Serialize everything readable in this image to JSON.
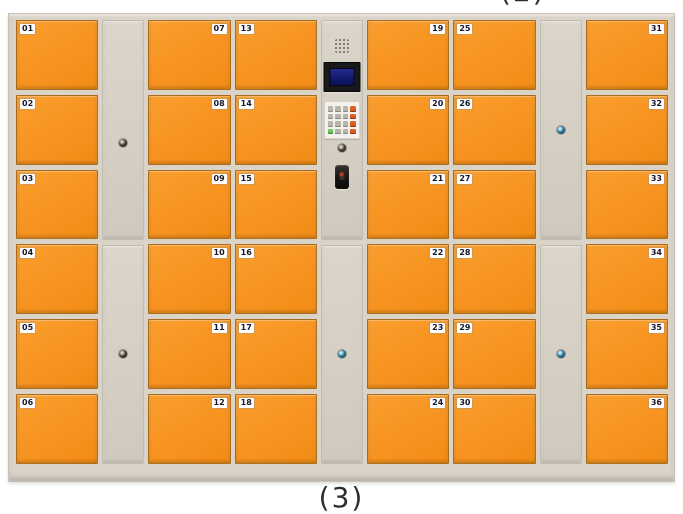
{
  "captions": {
    "top": "(2)",
    "bottom": "(3)"
  },
  "colors": {
    "door_orange": "#f79320",
    "door_orange_light": "#fa9e2e",
    "cabinet_beige": "#d9d3c8",
    "panel_beige": "#d4cec3",
    "label_bg": "#ffffff",
    "label_text": "#17172b",
    "keyhole_teal": "#2b7d9d",
    "screen_blue": "#131a70",
    "key_gray": "#b8b3ab",
    "key_red": "#d04d1c",
    "key_green": "#5bb748",
    "reader_red": "#c2452a"
  },
  "columns": [
    {
      "id": "lockers-01-06",
      "type": "lockers",
      "label_side": "left",
      "doors": [
        "01",
        "02",
        "03",
        "04",
        "05",
        "06"
      ]
    },
    {
      "id": "service-panel-left",
      "type": "service-panel",
      "sections": 2
    },
    {
      "id": "lockers-07-12",
      "type": "lockers",
      "label_side": "right",
      "doors": [
        "07",
        "08",
        "09",
        "10",
        "11",
        "12"
      ]
    },
    {
      "id": "lockers-13-18",
      "type": "lockers",
      "label_side": "left",
      "doors": [
        "13",
        "14",
        "15",
        "16",
        "17",
        "18"
      ]
    },
    {
      "id": "control-column",
      "type": "control"
    },
    {
      "id": "lockers-19-24",
      "type": "lockers",
      "label_side": "right",
      "doors": [
        "19",
        "20",
        "21",
        "22",
        "23",
        "24"
      ]
    },
    {
      "id": "lockers-25-30",
      "type": "lockers",
      "label_side": "left",
      "doors": [
        "25",
        "26",
        "27",
        "28",
        "29",
        "30"
      ]
    },
    {
      "id": "service-panel-right",
      "type": "service-panel",
      "sections": 2
    },
    {
      "id": "lockers-31-36",
      "type": "lockers",
      "label_side": "right",
      "doors": [
        "31",
        "32",
        "33",
        "34",
        "35",
        "36"
      ]
    }
  ],
  "control": {
    "components": [
      "speaker",
      "lcd-screen",
      "keypad",
      "keyhole",
      "card-reader"
    ],
    "keypad": {
      "layout": [
        [
          "gray",
          "gray",
          "gray",
          "red"
        ],
        [
          "gray",
          "gray",
          "gray",
          "red"
        ],
        [
          "gray",
          "gray",
          "gray",
          "red"
        ],
        [
          "green",
          "gray",
          "gray",
          "red"
        ]
      ]
    }
  }
}
